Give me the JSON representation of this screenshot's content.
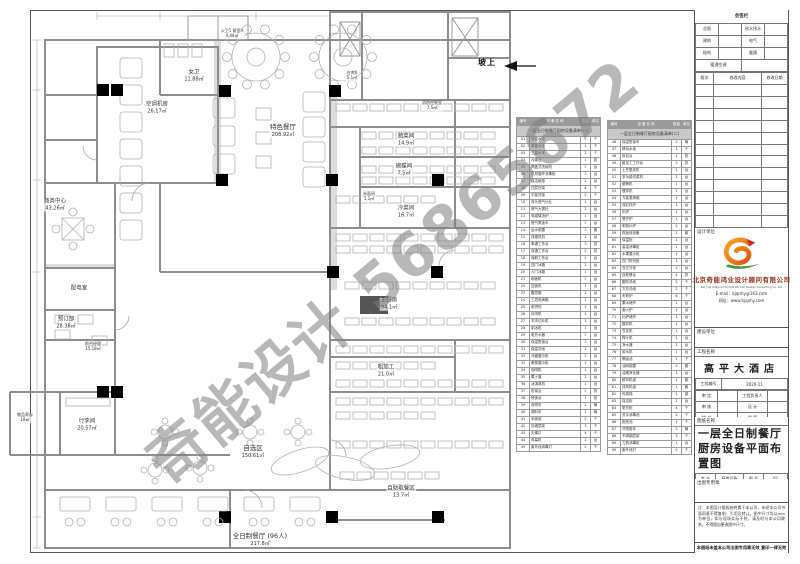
{
  "watermark": {
    "text": "奇能设计 56865672",
    "color": "#7d7d7d"
  },
  "plan": {
    "slope_label": "坡上",
    "rooms": [
      {
        "label": "空调机房",
        "area": "26.17㎡"
      },
      {
        "label": "公卫1 前室A",
        "area": "4.44㎡"
      },
      {
        "label": "女卫",
        "area": "11.88㎡"
      },
      {
        "label": "仓库6",
        "area": "5.1㎡"
      },
      {
        "label": "消防控制室",
        "area": "7.5㎡"
      },
      {
        "label": "特色餐厅",
        "area": "208.92㎡"
      },
      {
        "label": "蔬菜间",
        "area": "14.9㎡"
      },
      {
        "label": "碗碟间",
        "area": "7.5㎡"
      },
      {
        "label": "米面间",
        "area": "5.1㎡"
      },
      {
        "label": "冷菜间",
        "area": "16.7㎡"
      },
      {
        "label": "主厨房",
        "area": "94.1㎡"
      },
      {
        "label": "粗加工",
        "area": "21.0㎡"
      },
      {
        "label": "商务中心",
        "area": "43.26㎡"
      },
      {
        "label": "配电室",
        "area": ""
      },
      {
        "label": "预订部",
        "area": "28.38㎡"
      },
      {
        "label": "前台经理",
        "area": "15.18㎡"
      },
      {
        "label": "物品寄存",
        "area": "18㎡"
      },
      {
        "label": "行李间",
        "area": "20.57㎡"
      },
      {
        "label": "自选区",
        "area": "150.61㎡"
      },
      {
        "label": "自助取餐区",
        "area": "13.7㎡"
      },
      {
        "label": "全日制餐厅 (96人)",
        "area": "217.8㎡"
      }
    ]
  },
  "equipment_left": {
    "section": "一层全日制餐厅厨房设备清单(一)",
    "headers": [
      "编号",
      "设 备 名 称",
      "数量",
      "单位"
    ],
    "rows": [
      [
        "01",
        "双星水池",
        "2",
        "个"
      ],
      [
        "02",
        "单星水池",
        "1",
        "个"
      ],
      [
        "03",
        "三星水池",
        "2",
        "个"
      ],
      [
        "04",
        "污碟台",
        "1",
        "张"
      ],
      [
        "05",
        "揭盖式洗碗机",
        "1",
        "台"
      ],
      [
        "06",
        "热风循环消毒柜",
        "2",
        "台"
      ],
      [
        "07",
        "保洁碗柜",
        "2",
        "台"
      ],
      [
        "08",
        "四层货架",
        "4",
        "个"
      ],
      [
        "09",
        "平板货架",
        "2",
        "个"
      ],
      [
        "10",
        "双头燃气炒灶",
        "1",
        "台"
      ],
      [
        "11",
        "燃气大锅灶",
        "2",
        "台"
      ],
      [
        "12",
        "电磁矮汤炉",
        "1",
        "台"
      ],
      [
        "13",
        "燃气蒸饭车",
        "1",
        "台"
      ],
      [
        "14",
        "运水烟罩",
        "2",
        "套"
      ],
      [
        "15",
        "排烟风机",
        "1",
        "台"
      ],
      [
        "16",
        "单通工作台",
        "3",
        "张"
      ],
      [
        "17",
        "双通工作台",
        "2",
        "张"
      ],
      [
        "18",
        "保鲜工作台",
        "2",
        "台"
      ],
      [
        "19",
        "四门冰箱",
        "2",
        "台"
      ],
      [
        "20",
        "六门冰箱",
        "1",
        "台"
      ],
      [
        "21",
        "和面机",
        "1",
        "台"
      ],
      [
        "22",
        "压面机",
        "1",
        "台"
      ],
      [
        "23",
        "醒发箱",
        "1",
        "台"
      ],
      [
        "24",
        "三层电烤箱",
        "1",
        "台"
      ],
      [
        "25",
        "电饼铛",
        "1",
        "台"
      ],
      [
        "26",
        "绞肉机",
        "1",
        "台"
      ],
      [
        "27",
        "羊肉切片机",
        "1",
        "台"
      ],
      [
        "28",
        "制冰机",
        "1",
        "台"
      ],
      [
        "29",
        "电开水器",
        "1",
        "台"
      ],
      [
        "30",
        "保温售饭台",
        "2",
        "台"
      ],
      [
        "31",
        "保温汤池",
        "1",
        "台"
      ],
      [
        "32",
        "冷藏展示柜",
        "2",
        "台"
      ],
      [
        "33",
        "蛋糕展示柜",
        "1",
        "台"
      ],
      [
        "34",
        "咖啡机",
        "1",
        "台"
      ],
      [
        "35",
        "果汁鼎",
        "2",
        "台"
      ],
      [
        "36",
        "冰淇淋机",
        "1",
        "台"
      ],
      [
        "37",
        "布菜台",
        "2",
        "张"
      ],
      [
        "38",
        "残食台",
        "1",
        "张"
      ],
      [
        "39",
        "收残车",
        "2",
        "辆"
      ],
      [
        "40",
        "调料车",
        "1",
        "辆"
      ],
      [
        "41",
        "米面架",
        "2",
        "个"
      ],
      [
        "42",
        "挂墙层架",
        "3",
        "个"
      ],
      [
        "43",
        "灭蝇灯",
        "4",
        "个"
      ],
      [
        "44",
        "风幕机",
        "2",
        "台"
      ],
      [
        "45",
        "紫外线消毒灯",
        "2",
        "个"
      ]
    ]
  },
  "equipment_right": {
    "section": "一层全日制餐厅厨房设备清单(二)",
    "headers": [
      "编号",
      "设 备 名 称",
      "数量",
      "单位"
    ],
    "rows": [
      [
        "46",
        "保温售饭车",
        "2",
        "辆"
      ],
      [
        "47",
        "移动水池",
        "1",
        "个"
      ],
      [
        "48",
        "拆包台",
        "1",
        "张"
      ],
      [
        "49",
        "粗加工工作台",
        "2",
        "张"
      ],
      [
        "50",
        "土豆脱皮机",
        "1",
        "台"
      ],
      [
        "51",
        "多功能切菜机",
        "1",
        "台"
      ],
      [
        "52",
        "锯骨机",
        "1",
        "台"
      ],
      [
        "53",
        "搅拌机",
        "1",
        "台"
      ],
      [
        "54",
        "万能蒸烤箱",
        "1",
        "台"
      ],
      [
        "55",
        "双缸炸炉",
        "1",
        "台"
      ],
      [
        "56",
        "扒炉",
        "1",
        "台"
      ],
      [
        "57",
        "煲仔炉",
        "1",
        "台"
      ],
      [
        "58",
        "明档炒炉",
        "2",
        "台"
      ],
      [
        "59",
        "铁板烧设备",
        "1",
        "套"
      ],
      [
        "60",
        "保温柜",
        "2",
        "台"
      ],
      [
        "61",
        "高温消毒柜",
        "1",
        "台"
      ],
      [
        "62",
        "水果展示柜",
        "1",
        "台"
      ],
      [
        "63",
        "四门陈列柜",
        "1",
        "台"
      ],
      [
        "64",
        "岛式冷柜",
        "2",
        "台"
      ],
      [
        "65",
        "自助餐台",
        "4",
        "张"
      ],
      [
        "66",
        "圆形汤池",
        "2",
        "个"
      ],
      [
        "67",
        "方形汤池",
        "2",
        "个"
      ],
      [
        "68",
        "布菲炉",
        "6",
        "个"
      ],
      [
        "69",
        "果木烤炉",
        "1",
        "台"
      ],
      [
        "70",
        "面火炉",
        "1",
        "台"
      ],
      [
        "71",
        "比萨烤炉",
        "1",
        "台"
      ],
      [
        "72",
        "酸奶机",
        "1",
        "台"
      ],
      [
        "73",
        "豆浆机",
        "1",
        "台"
      ],
      [
        "74",
        "榨汁机",
        "1",
        "台"
      ],
      [
        "75",
        "净水器",
        "2",
        "台"
      ],
      [
        "76",
        "软水机",
        "1",
        "台"
      ],
      [
        "77",
        "隔油池",
        "1",
        "个"
      ],
      [
        "78",
        "油网烟罩",
        "2",
        "套"
      ],
      [
        "79",
        "油烟净化器",
        "1",
        "台"
      ],
      [
        "80",
        "鲜风机组",
        "1",
        "套"
      ],
      [
        "81",
        "排风机组",
        "1",
        "套"
      ],
      [
        "82",
        "传菜梯",
        "1",
        "部"
      ],
      [
        "83",
        "保洁柜",
        "2",
        "台"
      ],
      [
        "84",
        "更衣柜",
        "4",
        "个"
      ],
      [
        "85",
        "洗手消毒池",
        "2",
        "个"
      ],
      [
        "86",
        "拖把池",
        "1",
        "个"
      ],
      [
        "87",
        "货物推车",
        "2",
        "辆"
      ],
      [
        "88",
        "不锈钢层架",
        "3",
        "个"
      ],
      [
        "89",
        "刀具消毒柜",
        "1",
        "台"
      ],
      [
        "90",
        "紫外线灯",
        "2",
        "个"
      ]
    ]
  },
  "titleblock": {
    "signoff": {
      "title": "会签栏",
      "rows": [
        {
          "l": "总图",
          "r": "给水排水"
        },
        {
          "l": "建筑",
          "r": "电气"
        },
        {
          "l": "结构",
          "r": "暖通"
        }
      ],
      "bottom": "暖通空调"
    },
    "revision_headers": [
      "版次",
      "修改内容",
      "修改日期"
    ],
    "design_unit_label": "设计单位",
    "company": {
      "name": "北京奇能鸿业设计顾问有限公司",
      "en": "Bei Jing QiNeng HongYe Kitchen Design Consulting Co.,Ltd",
      "email": "E-mail：bjqnhy@163.com",
      "web": "网址：www.bjqnhy.com"
    },
    "construction_unit_label": "建设单位",
    "project_name_label": "工程名称",
    "project_name": "高平大酒店",
    "project_no_label": "工程编号",
    "project_no": "2020-11",
    "approval": [
      {
        "l": "审 定",
        "lv": "",
        "r": "工程负责人",
        "rv": ""
      },
      {
        "l": "审 核",
        "lv": "",
        "r": "设 计",
        "rv": ""
      },
      {
        "l": "校 对",
        "lv": "",
        "r": "制 图",
        "rv": ""
      },
      {
        "l": "专业负责人",
        "lv": "",
        "r": "日 期",
        "rv": "2020.12"
      }
    ],
    "drawing_name_label": "图纸名称",
    "drawing_title1": "一层全日制餐厅",
    "drawing_title2": "厨房设备平面布置图",
    "spec_rows": [
      {
        "l": "专 业",
        "lv": "厨房设备",
        "r": "图 号",
        "rv": "02"
      },
      {
        "l": "图 别",
        "lv": "施工图",
        "r": "比 例",
        "rv": "1:150"
      }
    ],
    "seal_label": "出图专用章",
    "notes": "注：本图设计版权始终属于本公司，未经本公司书面同意不得复制、引用及转让。图中尺寸均以mm为单位，如与现场实际不符，请及时与本公司联系，不得擅自更改图中尺寸。",
    "invalid_note": "本图纸未盖本公司出图专用章无效  复印一律无效"
  }
}
